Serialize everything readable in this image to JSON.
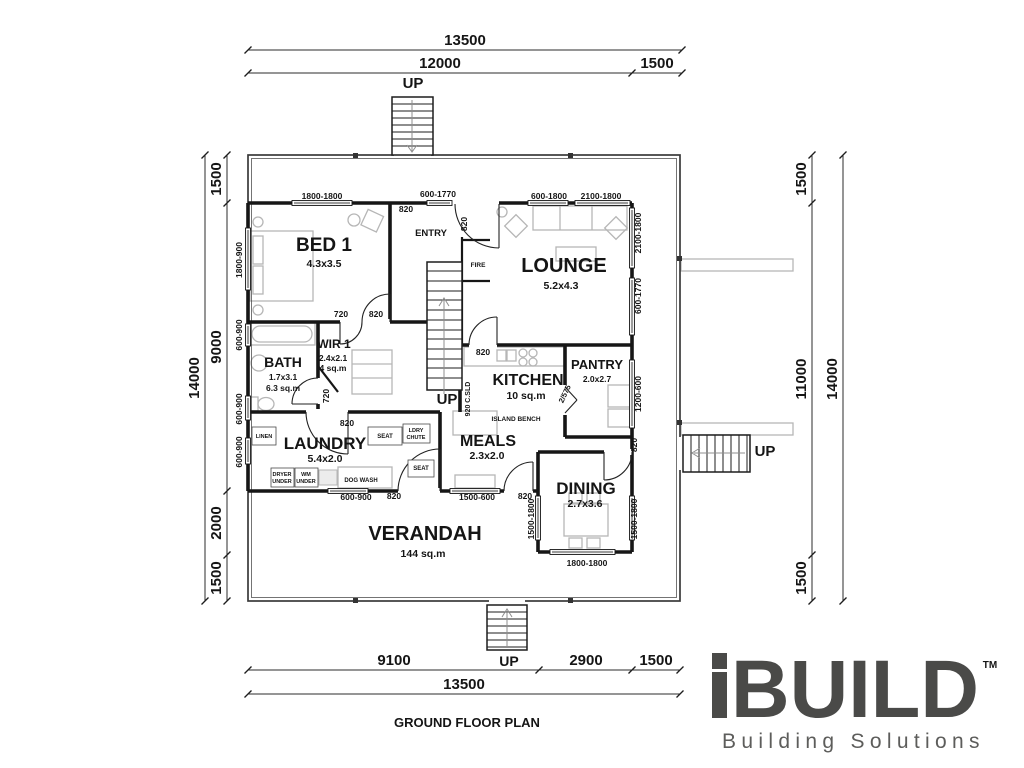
{
  "meta": {
    "plan_title": "GROUND FLOOR PLAN"
  },
  "logo": {
    "i": "i",
    "brand": "BUILD",
    "tm": "TM",
    "tagline": "Building Solutions",
    "brand_color": "#4a4a48"
  },
  "rooms": {
    "bed1": {
      "name": "BED 1",
      "size": "4.3x3.5"
    },
    "lounge": {
      "name": "LOUNGE",
      "size": "5.2x4.3"
    },
    "wir1": {
      "name": "WIR 1",
      "size": "2.4x2.1",
      "area": "4 sq.m"
    },
    "bath": {
      "name": "BATH",
      "size": "1.7x3.1",
      "area": "6.3 sq.m"
    },
    "kitchen": {
      "name": "KITCHEN",
      "area": "10 sq.m"
    },
    "pantry": {
      "name": "PANTRY",
      "size": "2.0x2.7"
    },
    "laundry": {
      "name": "LAUNDRY",
      "size": "5.4x2.0"
    },
    "meals": {
      "name": "MEALS",
      "size": "2.3x2.0"
    },
    "dining": {
      "name": "DINING",
      "size": "2.7x3.6"
    },
    "verandah": {
      "name": "VERANDAH",
      "area": "144 sq.m"
    },
    "entry": {
      "name": "ENTRY"
    }
  },
  "fixtures": {
    "fire": "FIRE",
    "island_bench": "ISLAND BENCH",
    "linen": "LINEN",
    "seat": "SEAT",
    "ldry": "LDRY",
    "chute": "CHUTE",
    "dryer": "DRYER",
    "wm": "WM",
    "under": "UNDER",
    "dog_wash": "DOG WASH",
    "up": "UP",
    "cavity_slider": "920 C.SLD",
    "pantry_doors": "2/575"
  },
  "dim_chains": {
    "top_overall": "13500",
    "top_main": "12000",
    "top_right": "1500",
    "bottom_left": "9100",
    "bottom_mid": "2900",
    "bottom_right": "1500",
    "bottom_overall": "13500",
    "left_top": "1500",
    "left_main": "9000",
    "left_lower": "2000",
    "left_bottom": "1500",
    "left_overall": "14000",
    "right_top": "1500",
    "right_main": "11000",
    "right_bottom": "1500",
    "right_overall": "14000"
  },
  "wall_dims": {
    "w1800_1800": "1800-1800",
    "w600_1770": "600-1770",
    "w600_1800": "600-1800",
    "w2100_1800": "2100-1800",
    "w1800_900": "1800-900",
    "w600_900": "600-900",
    "w1200_600": "1200-600",
    "w1500_600": "1500-600",
    "w1500_1800": "1500-1800",
    "d820": "820",
    "d720": "720"
  }
}
